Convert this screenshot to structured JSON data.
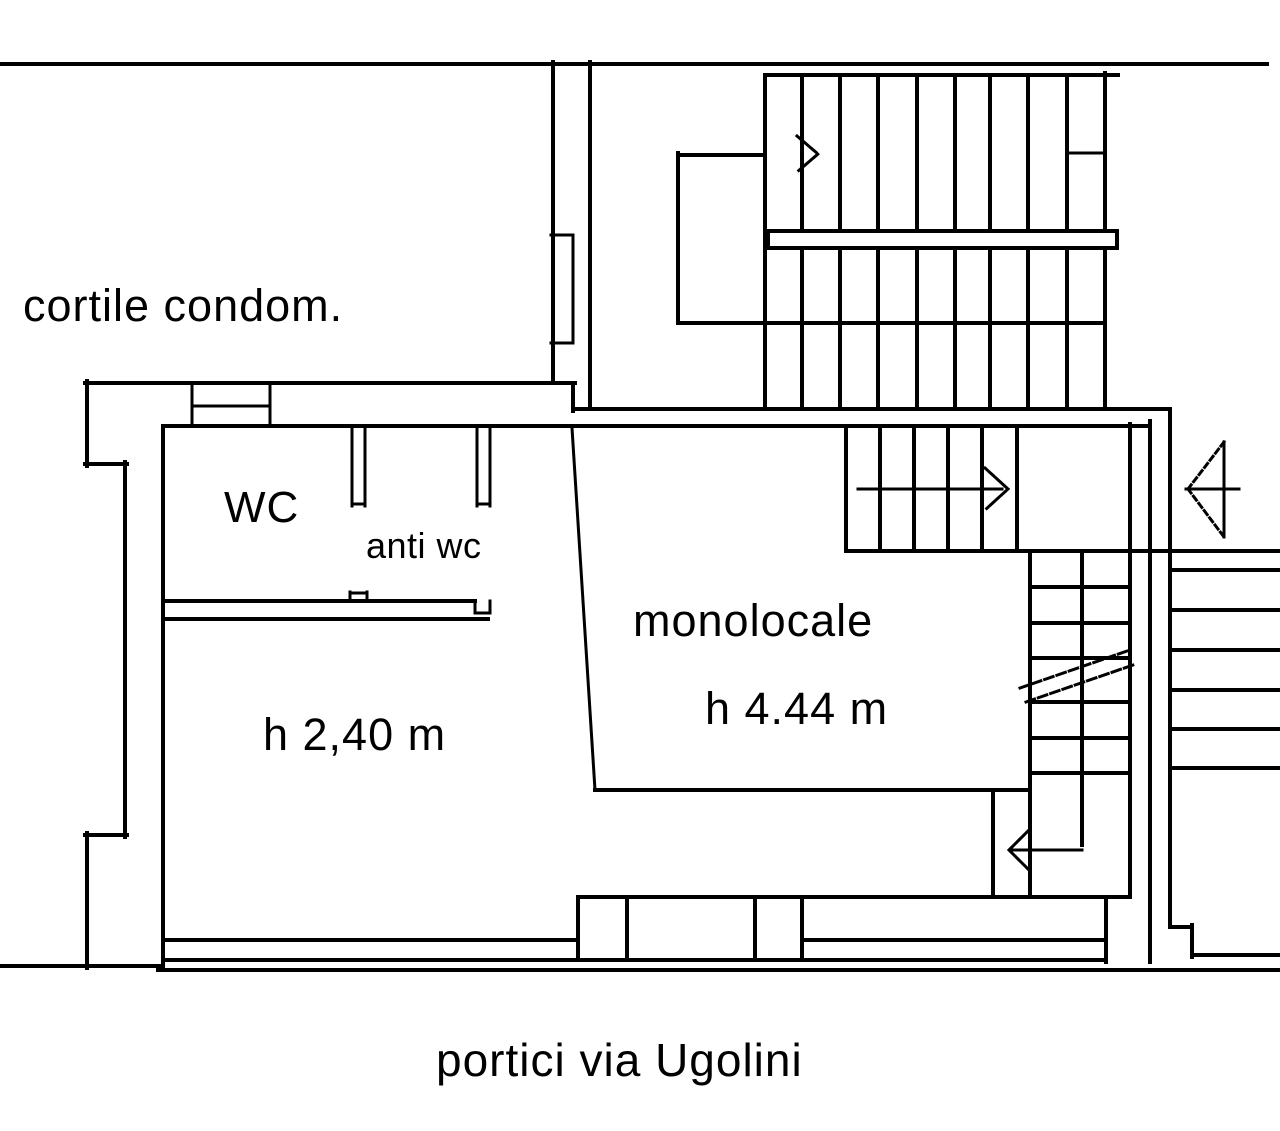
{
  "drawing": {
    "type": "floor-plan",
    "labels": {
      "courtyard": "cortile condom.",
      "wc": "WC",
      "anti_wc": "anti wc",
      "left_room_height": "h 2,40 m",
      "main_room": "monolocale",
      "main_room_height": "h 4.44 m",
      "street": "portici via Ugolini"
    },
    "colors": {
      "line": "#000000",
      "background": "#ffffff"
    }
  }
}
